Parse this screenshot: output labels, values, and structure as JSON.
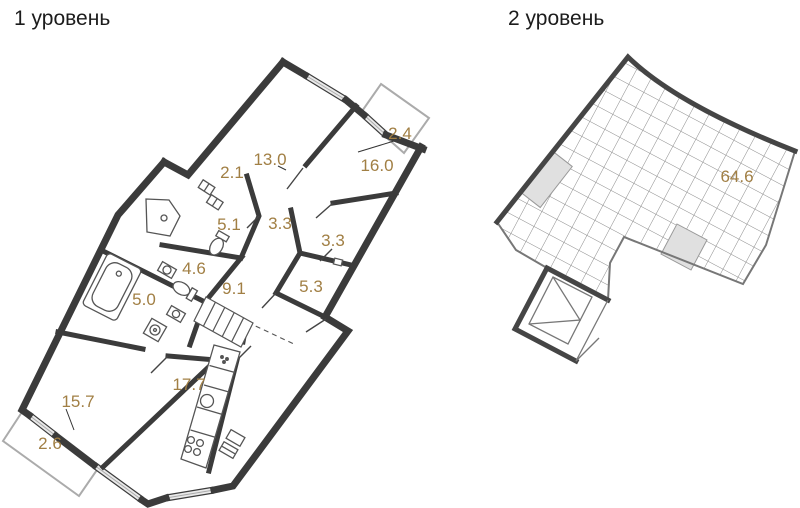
{
  "titles": {
    "level1": "1 уровень",
    "level2": "2 уровень"
  },
  "colors": {
    "wall_dark": "#3b3b3b",
    "wall_medium": "#454545",
    "wall_light": "#777777",
    "balcony_outline": "#ababab",
    "window_fill": "#e9e9e9",
    "grid_line": "#8a8a8a",
    "highlight_fill": "#e0e0e0",
    "area_label": "#a17f44",
    "title_color": "#1c1c1c"
  },
  "level1": {
    "areas": {
      "balcony_top": "2.4",
      "room_13": "13.0",
      "room_16": "16.0",
      "closet": "2.1",
      "hall_upper": "3.3",
      "bath_51": "5.1",
      "hall_right": "3.3",
      "storage": "5.3",
      "bath_46": "4.6",
      "hall_stairs": "9.1",
      "bath_50": "5.0",
      "kitchen": "17.7",
      "living": "15.7",
      "balcony_bottom": "2.6"
    }
  },
  "level2": {
    "areas": {
      "attic": "64.6"
    }
  }
}
